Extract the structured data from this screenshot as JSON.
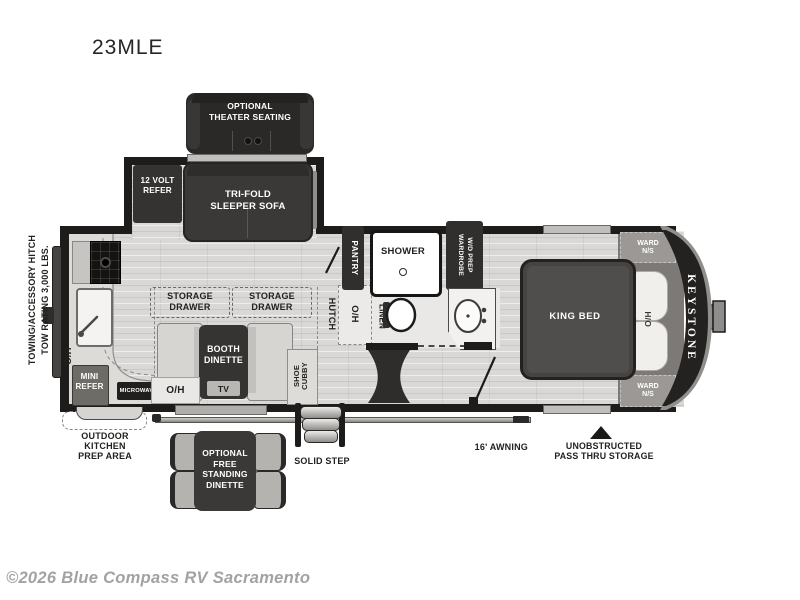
{
  "title": "23MLE",
  "watermark": "©2026 Blue Compass RV Sacramento",
  "brand": "KEYSTONE",
  "colors": {
    "wall": "#1d1c1b",
    "dark_furniture": "#302f2d",
    "floor": "#d9d8d6",
    "bedroom_band": "#7c7976",
    "label_light": "#ffffff",
    "label_dark": "#22211f",
    "watermark_gray": "#a3a2a0"
  },
  "exterior": {
    "towing": {
      "line1": "TOWING/ACCESSORY HITCH",
      "line2": "TOW RATING 3,000 LBS."
    },
    "awning": "16' AWNING",
    "solid_step": "SOLID STEP",
    "pass_thru": {
      "line1": "UNOBSTRUCTED",
      "line2": "PASS THRU STORAGE"
    },
    "outdoor_kitchen": {
      "line1": "OUTDOOR",
      "line2": "KITCHEN",
      "line3": "PREP AREA"
    },
    "free_dinette": {
      "line1": "OPTIONAL",
      "line2": "FREE",
      "line3": "STANDING",
      "line4": "DINETTE"
    }
  },
  "living": {
    "theater": {
      "line1": "OPTIONAL",
      "line2": "THEATER SEATING"
    },
    "refer12": {
      "line1": "12 VOLT",
      "line2": "REFER"
    },
    "sofa": {
      "line1": "TRI-FOLD",
      "line2": "SLEEPER SOFA"
    },
    "storage_left": {
      "line1": "STORAGE",
      "line2": "DRAWER"
    },
    "storage_right": {
      "line1": "STORAGE",
      "line2": "DRAWER"
    },
    "booth": {
      "line1": "BOOTH",
      "line2": "DINETTE"
    },
    "tv": "TV",
    "oh_booth": "O/H",
    "shoe": {
      "line1": "SHOE",
      "line2": "CUBBY"
    },
    "hutch": "HUTCH",
    "oh_hutch": "O/H"
  },
  "kitchen": {
    "oh": "O/H",
    "mini_refer": {
      "line1": "MINI",
      "line2": "REFER"
    },
    "microwave": "MICROWAVE"
  },
  "bath": {
    "pantry": "PANTRY",
    "shower": "SHOWER",
    "wardrobe": {
      "line1": "WARDROBE",
      "line2": "W/D PREP"
    },
    "linen": "LINEN"
  },
  "bedroom": {
    "bed": "KING BED",
    "ward_top": {
      "line1": "WARD",
      "line2": "N/S"
    },
    "ward_bottom": {
      "line1": "WARD",
      "line2": "N/S"
    },
    "oh": "O/H"
  }
}
